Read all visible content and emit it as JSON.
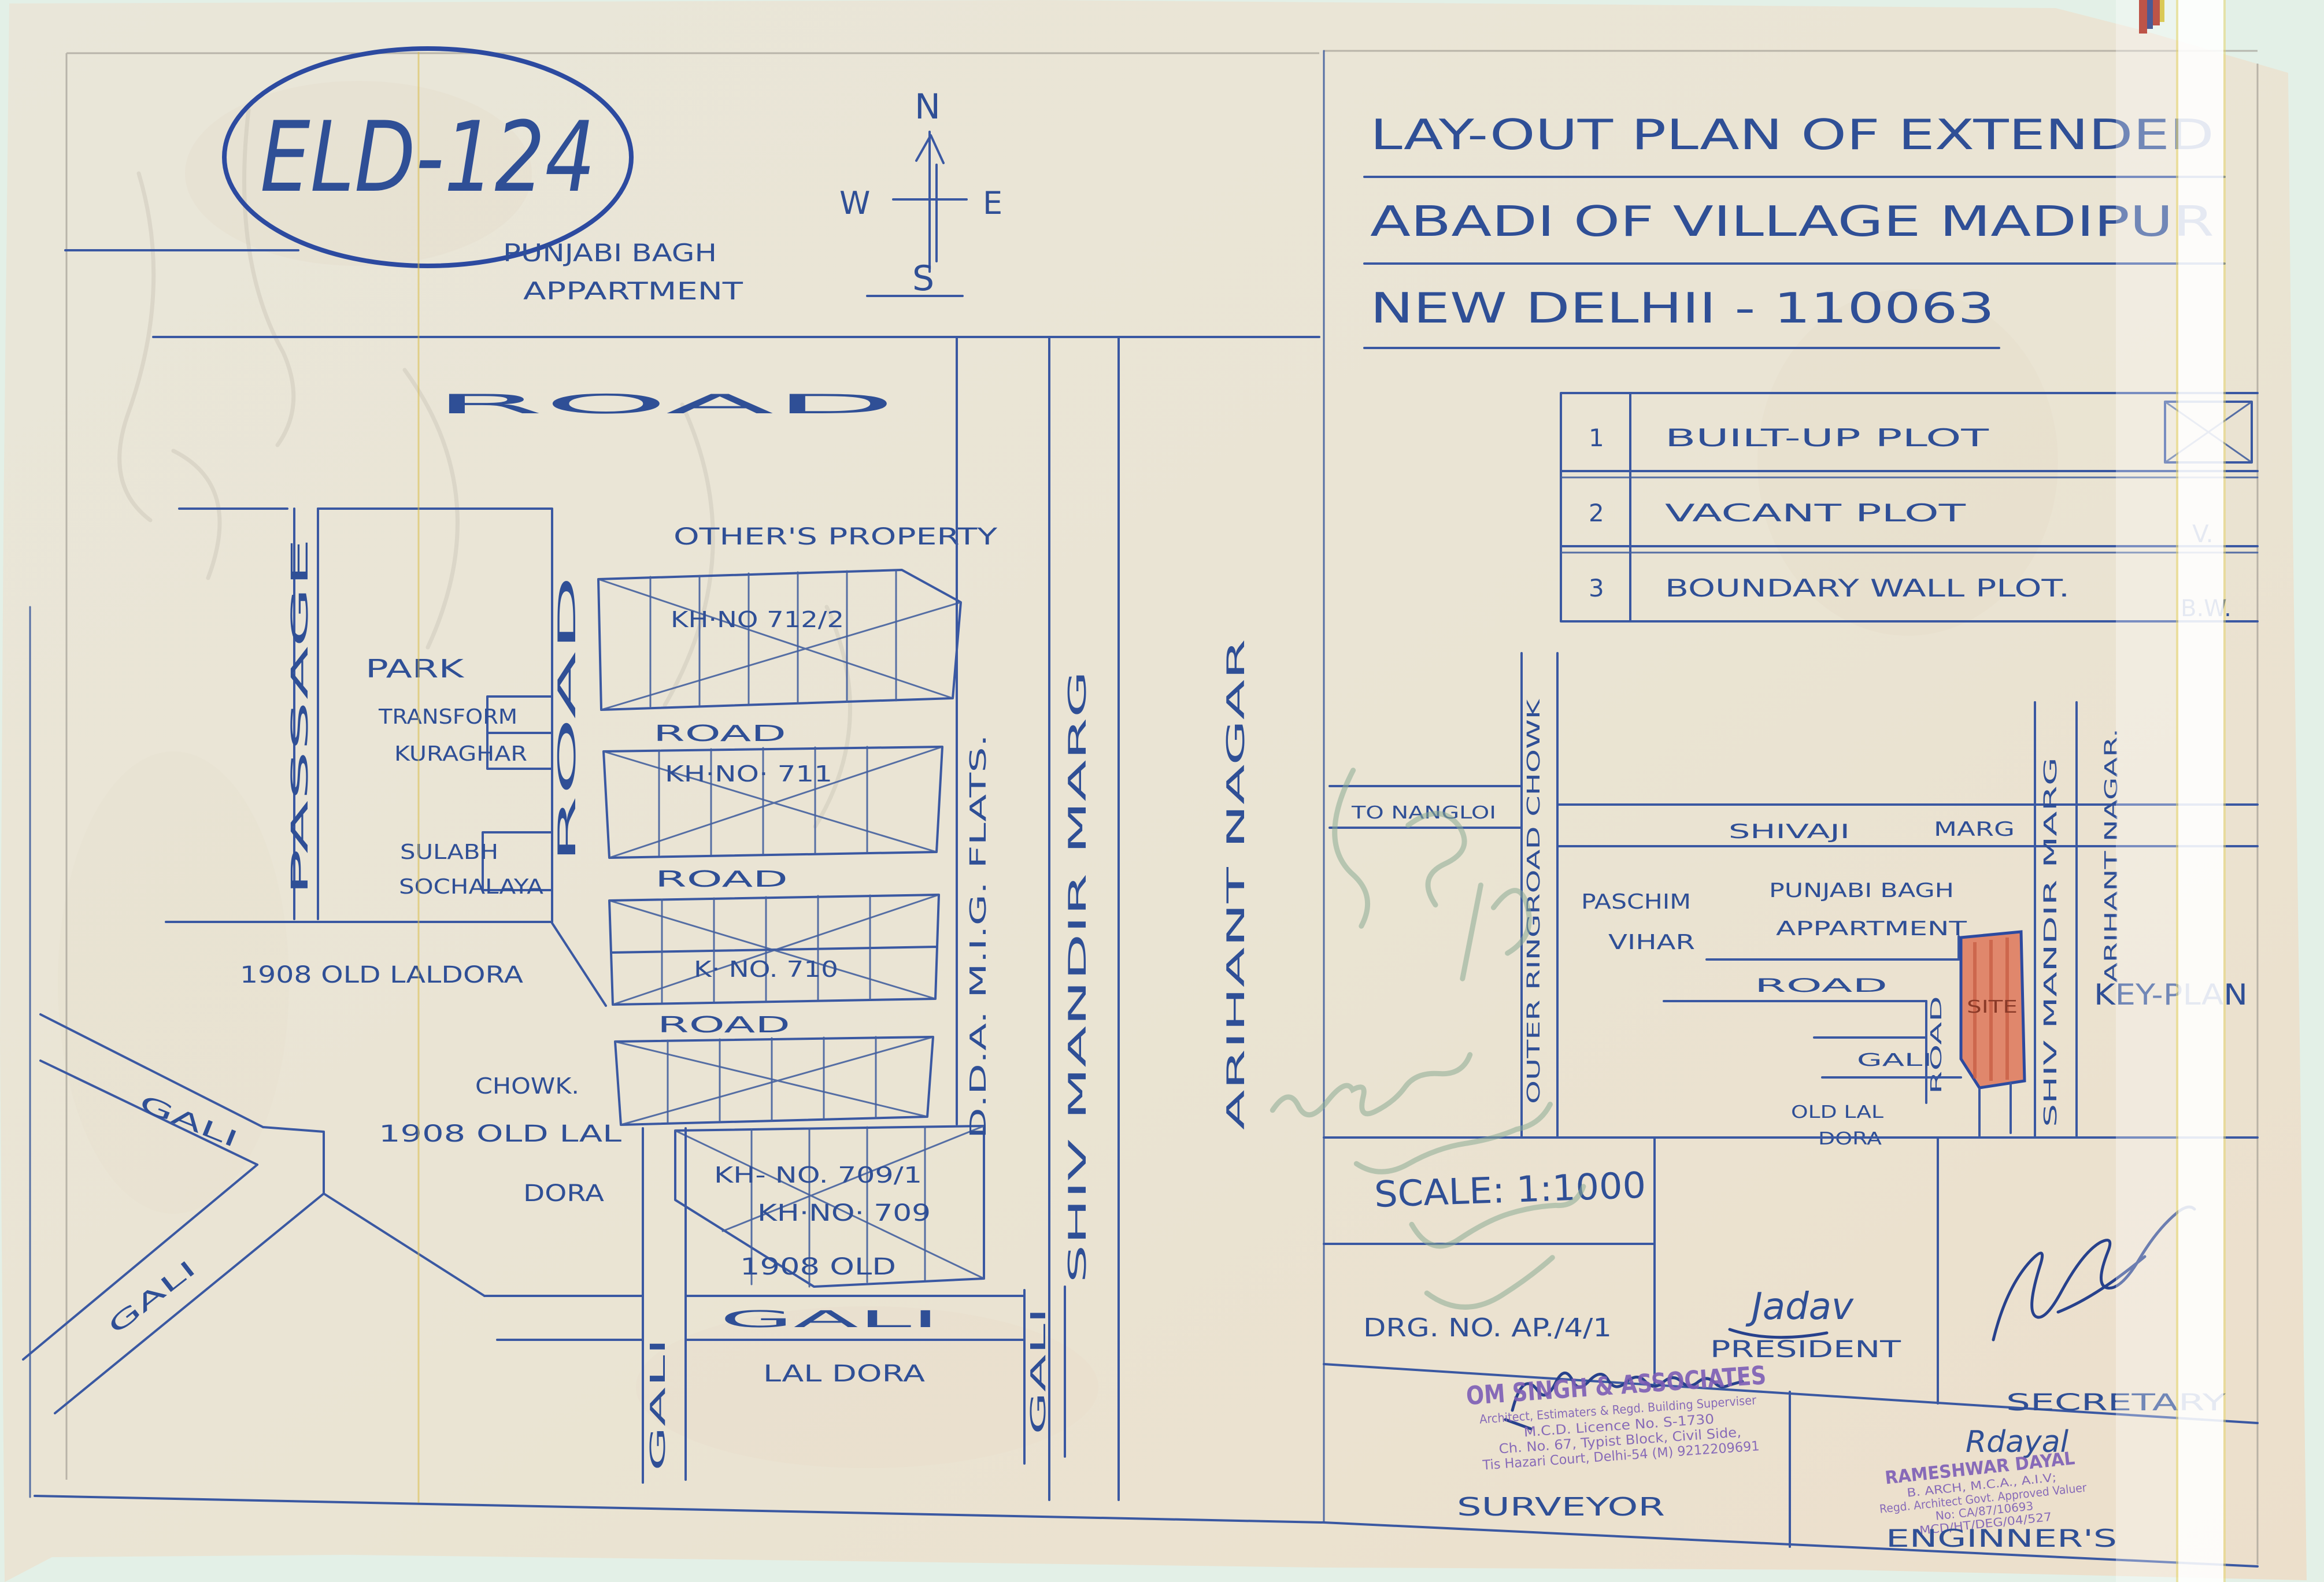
{
  "document": {
    "code": "ELD-124",
    "title_line1": "LAY-OUT PLAN OF EXTENDED",
    "title_line2": "ABADI OF VILLAGE MADIPUR",
    "title_line3": "NEW DELHII - 110063",
    "scale": "SCALE: 1:1000",
    "drawing_no": "DRG. NO. AP./4/1"
  },
  "compass": {
    "n": "N",
    "e": "E",
    "w": "W",
    "s": "S"
  },
  "legend": {
    "rows": [
      {
        "no": "1",
        "label": "BUILT-UP PLOT",
        "symbol": ""
      },
      {
        "no": "2",
        "label": "VACANT PLOT",
        "symbol": "V."
      },
      {
        "no": "3",
        "label": "BOUNDARY WALL PLOT.",
        "symbol": "B.W."
      }
    ]
  },
  "plan": {
    "punjabi_bagh": "PUNJABI BAGH",
    "appartment": "APPARTMENT",
    "road": "ROAD",
    "passage": "PASSAGE",
    "park": "PARK",
    "transform": "TRANSFORM",
    "kuraghar": "KURAGHAR",
    "sulabh": "SULABH",
    "sochalaya": "SOCHALAYA",
    "old_laldora": "1908 OLD LALDORA",
    "others_property": "OTHER'S PROPERTY",
    "kh_712_2": "KH·NO 712/2",
    "kh_711": "KH·NO· 711",
    "kh_710": "K· NO. 710",
    "kh_709_1": "KH- NO. 709/1",
    "chowk": "CHOWK.",
    "gali": "GALI",
    "kh_709": "KH·NO· 709",
    "old_1908": "1908 OLD",
    "lal_dora": "LAL DORA",
    "old_lal_left": "1908 OLD LAL",
    "dora": "DORA",
    "dda_mig_flats": "D.D.A. M.I.G. FLATS.",
    "shiv_mandir_marg": "SHIV MANDIR MARG",
    "arihant_nagar": "ARIHANT NAGAR"
  },
  "key_plan": {
    "to_nangloi": "TO NANGLOI",
    "outer_ringroad_chowk": "OUTER RINGROAD CHOWK",
    "shivaji": "SHIVAJI",
    "marg": "MARG",
    "paschim": "PASCHIM",
    "vihar": "VIHAR",
    "punjabi_bagh": "PUNJABI BAGH",
    "appartment": "APPARTMENT",
    "road": "ROAD",
    "site": "SITE",
    "gali": "GALI",
    "old_lal": "OLD LAL",
    "dora": "DORA",
    "shiv_mandir_marg": "SHIV MANDIR MARG",
    "arihant_nagar": "ARIHANT NAGAR.",
    "title": "KEY-PLAN"
  },
  "approvals": {
    "president_label": "PRESIDENT",
    "president_sig": "Jadav",
    "secretary_label": "SECRETARY",
    "surveyor_label": "SURVEYOR",
    "engineer_label": "ENGINNER'S",
    "engineer_sig": "Rdayal"
  },
  "stamps": {
    "surveyor": {
      "line1": "OM SINGH & ASSOCIATES",
      "line2": "Architect, Estimaters & Regd. Building Superviser",
      "line3": "M.C.D. Licence No. S-1730",
      "line4": "Ch. No. 67, Typist Block, Civil Side,",
      "line5": "Tis Hazari Court, Delhi-54 (M) 9212209691"
    },
    "engineer": {
      "line1": "RAMESHWAR DAYAL",
      "line2": "B. ARCH, M.C.A., A.I.V;",
      "line3": "Regd. Architect Govt. Approved Valuer",
      "line4": "No: CA/87/10693",
      "line5": "MCD/HT/DEG/04/527"
    }
  },
  "colors": {
    "ink": "#2f4f96",
    "stamp_purple": "#7d5eb6",
    "site_red": "#dd7052",
    "paper": "#eae5d5",
    "scanner_bed": "#e3f0e7"
  }
}
